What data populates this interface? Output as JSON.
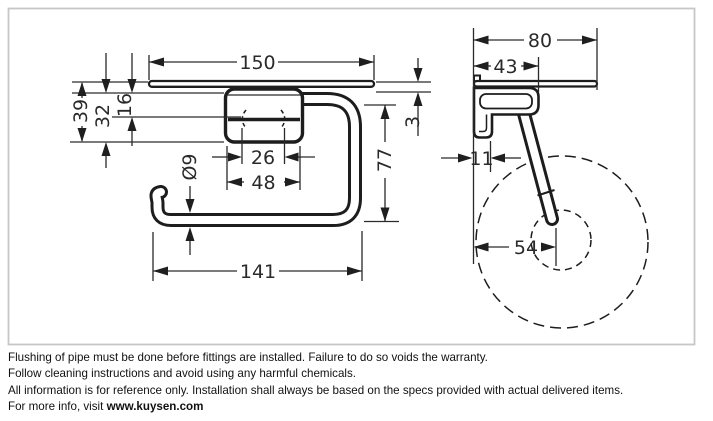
{
  "front_view": {
    "dims": {
      "shelf_width": "150",
      "height_total": "39",
      "height_mid": "32",
      "height_small": "16",
      "hole_spacing": "26",
      "plate_width": "48",
      "bar_diameter": "Ø9",
      "bar_drop": "77",
      "shelf_gap": "3",
      "bar_length": "141"
    }
  },
  "side_view": {
    "dims": {
      "shelf_depth": "80",
      "holder_depth": "43",
      "wall_thickness": "11",
      "roll_offset": "54"
    }
  },
  "footer": {
    "line1": "Flushing of pipe must be done before fittings are installed. Failure to do so voids the warranty.",
    "line2": "Follow cleaning instructions and avoid using any harmful chemicals.",
    "line3": "All information is for reference only. Installation shall always be based on the specs provided with actual delivered items.",
    "line4_prefix": "For more info, visit ",
    "line4_link": "www.kuysen.com"
  },
  "colors": {
    "line": "#1d1d1d",
    "dimension": "#2a2a2a",
    "frame": "#c7c7c7",
    "background": "#ffffff"
  }
}
